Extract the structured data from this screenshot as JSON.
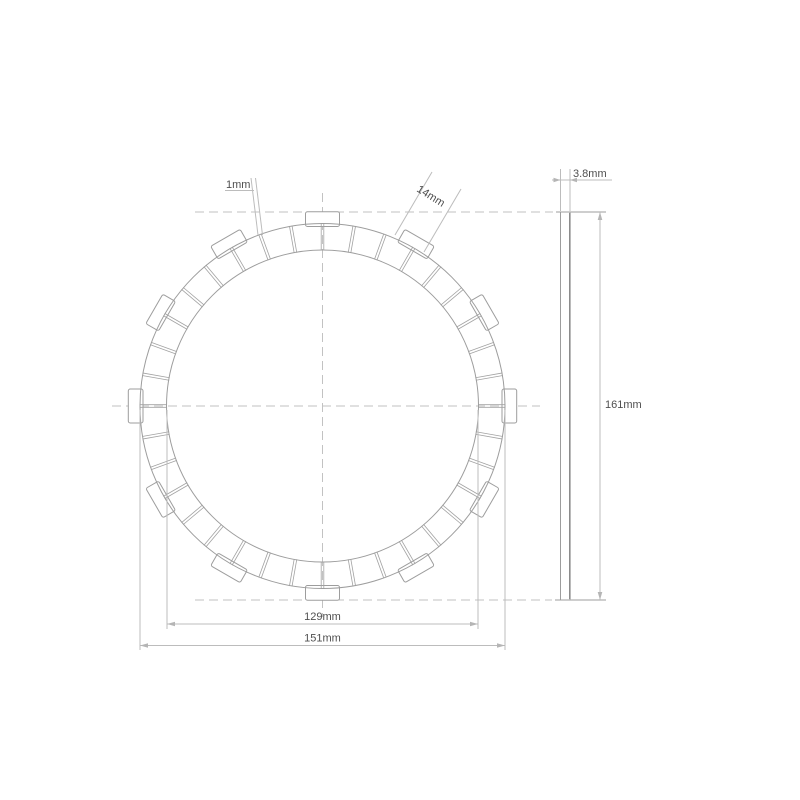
{
  "drawing": {
    "type": "clutch friction plate technical drawing",
    "labels": {
      "groove_width": "1mm",
      "tab_width": "14mm",
      "thickness": "3.8mm",
      "overall_diameter": "161mm",
      "inner_diameter": "129mm",
      "friction_outer_diameter": "151mm"
    },
    "dimensions_mm": {
      "groove_width": 1,
      "tab_width": 14,
      "thickness": 3.8,
      "overall_diameter": 161,
      "inner_diameter": 129,
      "friction_outer_diameter": 151
    },
    "geometry": {
      "center_x": 322.5,
      "center_y": 406,
      "r_outer": 182.5,
      "r_inner": 156,
      "r_tab": 194.2,
      "tab_width_px": 34,
      "tab_count": 12,
      "pad_count": 36,
      "groove_half_gap_px": 1.3
    },
    "colors": {
      "line": "#9d9d9d",
      "dimension": "#bcbcbc",
      "dash": "#c2c2c2",
      "text": "#4f4f4f",
      "background": "#ffffff"
    }
  }
}
